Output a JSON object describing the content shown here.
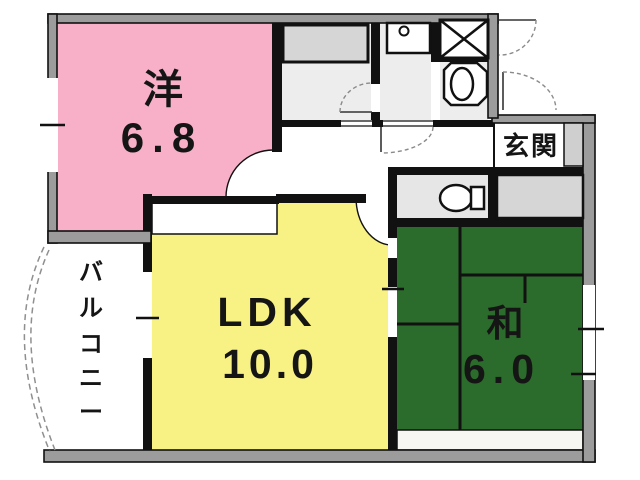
{
  "title": "apartment-floor-plan",
  "colors": {
    "western_room": "#f7b0c7",
    "ldk": "#f8f183",
    "japanese_room": "#2b6b2b",
    "wall_gray": "#9c9c9c",
    "utility_floor": "#ededed",
    "toilet_floor": "#e6e6e6",
    "closet_gray": "#d6d6d6",
    "tatami_edge": "#f6f6f2",
    "line_black": "#111111"
  },
  "rooms": {
    "western": {
      "label": "洋",
      "area": "6.8"
    },
    "ldk": {
      "label": "LDK",
      "area": "10.0"
    },
    "japanese": {
      "label": "和",
      "area": "6.0"
    },
    "entrance": {
      "label": "玄関"
    },
    "balcony": {
      "label": "バルコニー",
      "chars": [
        "バ",
        "ル",
        "コ",
        "ニ",
        "ー"
      ]
    }
  },
  "fixtures": {
    "washing_machine_pan": "washing-machine-pan",
    "pipe_space": "pipe-space-crossbox",
    "washbasin": "washbasin",
    "toilet": "toilet",
    "kitchen_counter": "kitchen-counter",
    "closet": "closet"
  }
}
